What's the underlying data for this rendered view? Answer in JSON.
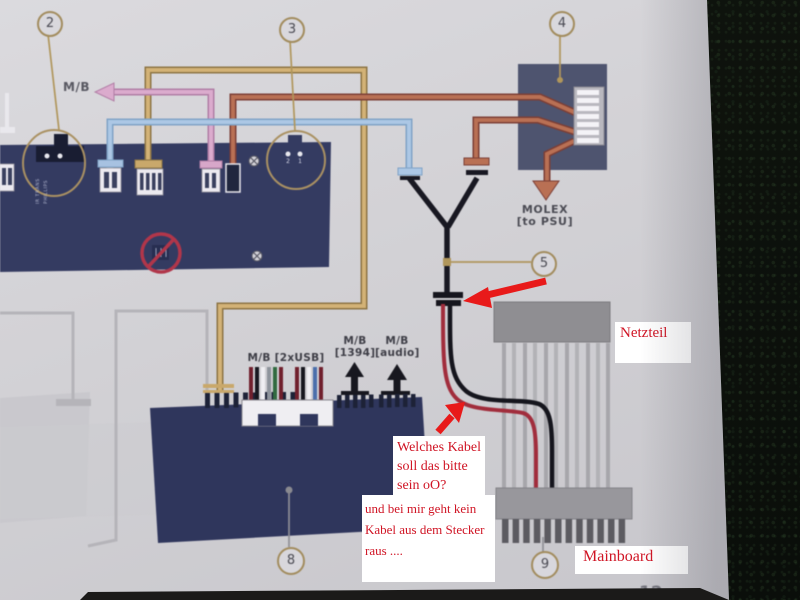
{
  "diagram": {
    "callouts": {
      "n2": "2",
      "n3": "3",
      "n4": "4",
      "n5": "5",
      "n8": "8",
      "n9": "9"
    },
    "labels": {
      "mb_arrow": "M/B",
      "molex_line1": "MOLEX",
      "molex_line2": "[to PSU]",
      "usb": "M/B [2xUSB]",
      "firewire_line1": "M/B",
      "firewire_line2": "[1394]",
      "audio_line1": "M/B",
      "audio_line2": "[audio]",
      "pin_left": "2",
      "pin_right": "1",
      "conn2_vertical_a": "IR TRANS",
      "conn2_vertical_b": "PHILLIPS"
    },
    "page_number": "12"
  },
  "annotations": {
    "netzteil": "Netzteil",
    "mainboard": "Mainboard",
    "question1": {
      "line1": "Welches Kabel",
      "line2": "soll das bitte",
      "line3": "sein oO?"
    },
    "question2": {
      "line1": "und bei mir geht kein",
      "line2": "Kabel aus dem Stecker",
      "line3": "raus ...."
    }
  },
  "colors": {
    "annotation_red": "#d01525",
    "arrow_red": "#e81a1a",
    "wire_gold": "#d4b273",
    "wire_pink": "#dcaace",
    "wire_blue": "#abc7e6",
    "wire_brick": "#bb6f52",
    "board_navy": "#343b63",
    "paper": "#d2d1d5"
  }
}
